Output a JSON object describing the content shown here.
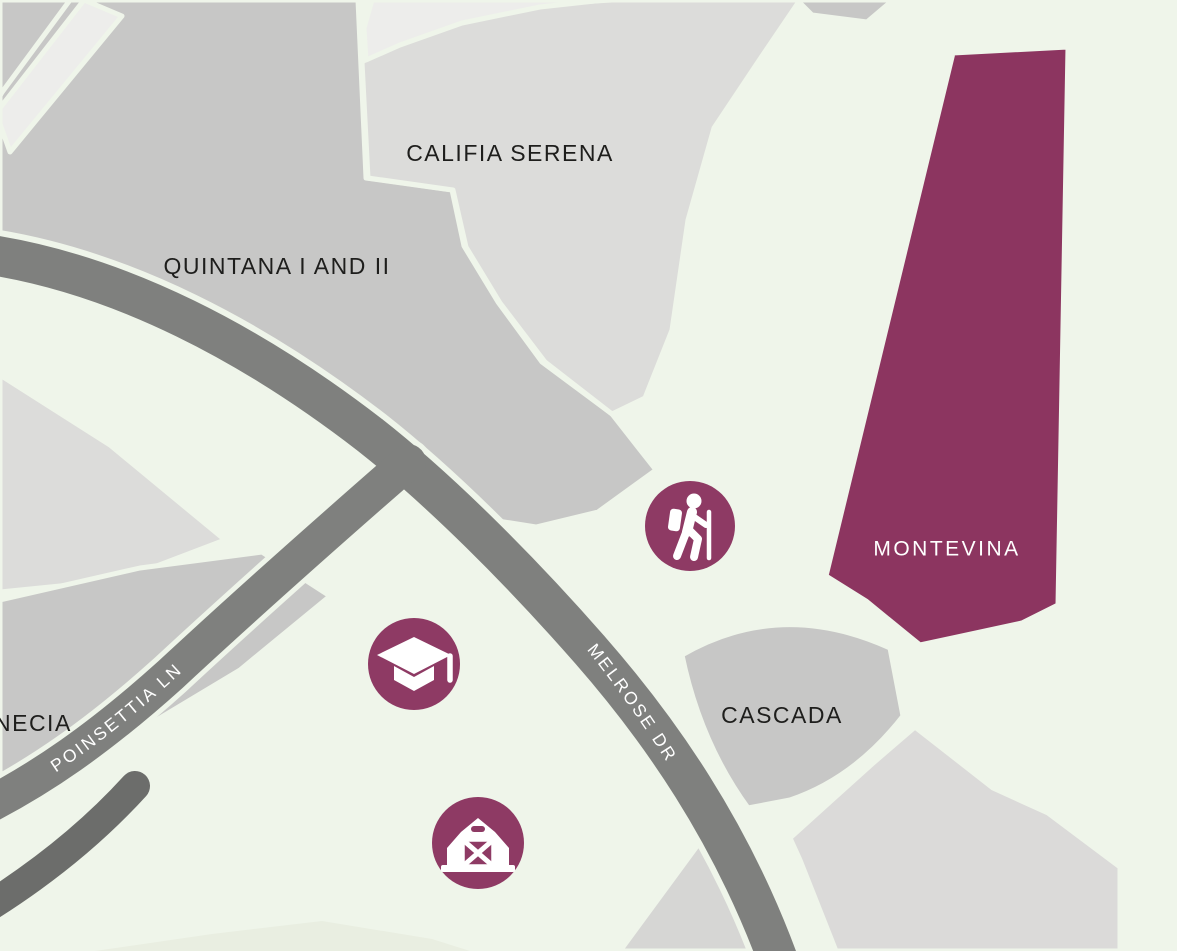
{
  "colors": {
    "background": "#eff5ea",
    "region_gray": "#c7c7c6",
    "region_light_gray": "#dcdcda",
    "region_pale": "#ededeb",
    "region_lavender": "#dbdad9",
    "region_mid_light": "#d6d6d4",
    "region_faint": "#e9eee1",
    "road": "#7f807e",
    "road_dark": "#6c6d6b",
    "accent_purple": "#8c3560",
    "icon_purple": "#8e3a64",
    "icon_glyph": "#ffffff",
    "label_text": "#1e1e1c",
    "street_label": "#ffffff"
  },
  "neighborhoods": [
    {
      "id": "quintana-i-and-ii",
      "label": "QUINTANA I AND II"
    },
    {
      "id": "califia-serena",
      "label": "CALIFIA SERENA"
    },
    {
      "id": "montevina",
      "label": "MONTEVINA"
    },
    {
      "id": "cascada",
      "label": "CASCADA"
    },
    {
      "id": "necia",
      "label": "NECIA"
    }
  ],
  "streets": [
    {
      "id": "poinsettia-ln",
      "label": "POINSETTIA LN"
    },
    {
      "id": "melrose-dr",
      "label": "MELROSE DR"
    }
  ],
  "markers": [
    {
      "id": "hiker",
      "icon": "hiker-icon"
    },
    {
      "id": "graduation-cap",
      "icon": "graduation-cap-icon"
    },
    {
      "id": "barn",
      "icon": "barn-icon"
    }
  ]
}
